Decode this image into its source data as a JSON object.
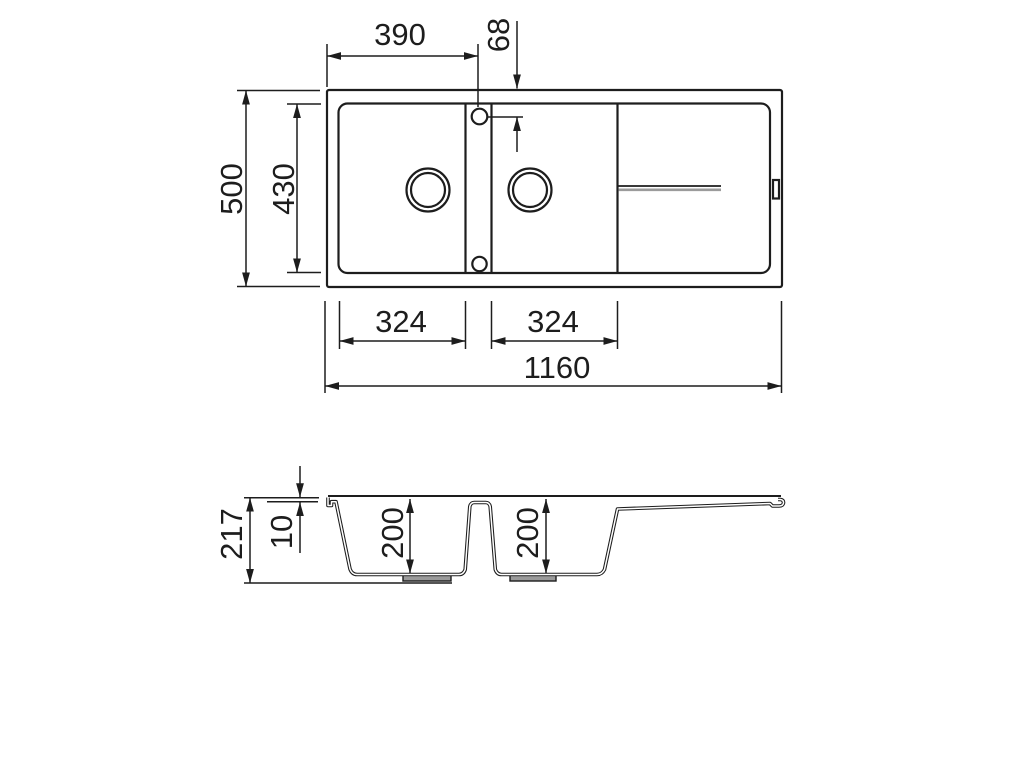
{
  "drawing": {
    "subject": "double-bowl-sink-with-drainer-technical-drawing",
    "colors": {
      "line": "#1d1d1d",
      "background": "#ffffff",
      "groove_gray": "#9b9b9b",
      "recess_gray": "#9a9a9a"
    },
    "top_view": {
      "dims": {
        "tap_offset_x": "390",
        "tap_offset_y": "68",
        "overall_depth": "500",
        "inner_depth": "430",
        "left_bowl_width": "324",
        "right_bowl_width": "324",
        "overall_width": "1160"
      }
    },
    "section_view": {
      "dims": {
        "overall_height": "217",
        "rim_thickness": "10",
        "left_bowl_depth": "200",
        "right_bowl_depth": "200"
      }
    }
  }
}
